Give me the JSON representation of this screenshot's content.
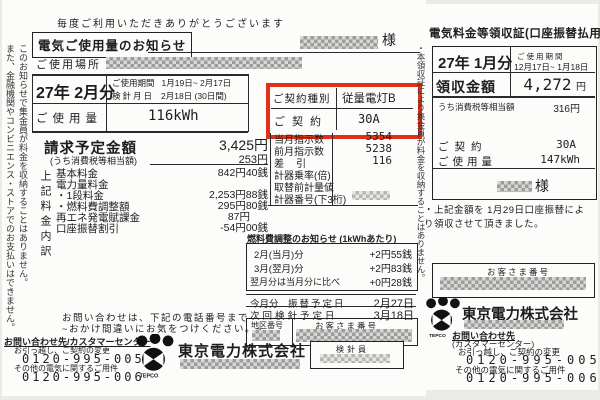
{
  "highlight_color": "#e23018",
  "company_logo_text": "TEPCO",
  "left_doc": {
    "side_note_1": "このお知らせで集金員が料金を収納することはありません。",
    "side_note_2": "また、金融機関やコンビニエンス・ストアでのお支払いはできません。",
    "thanks": "毎度ご利用いただきありがとうございます",
    "title": "電気ご使用量のお知らせ",
    "honorific": "様",
    "place_label": "ご使用場所",
    "billing_month": "27年 2月分",
    "period_label": "ご使用期間",
    "period_value": "1月19日~ 2月17日",
    "reading_label": "検針月日",
    "reading_value": "2月18日 (30日間)",
    "usage_label": "ご使用量",
    "usage_value": "116kWh",
    "contract_type_label": "ご契約種別",
    "contract_type_value": "従量電灯B",
    "contract_label": "ご契約",
    "contract_value": "30A",
    "billing_amount_label": "請求予定金額",
    "billing_amount_value": "3,425円",
    "tax_label": "(うち消費税等相当額)",
    "tax_value": "253円",
    "breakdown_side_label": "上記料金内訳",
    "breakdown": [
      {
        "label": "基本料金",
        "value": "842円40銭"
      },
      {
        "label": "電力量料金",
        "value": ""
      },
      {
        "label": "・1段料金",
        "value": "2,253円88銭"
      },
      {
        "label": "・燃料費調整額",
        "value": "295円80銭"
      },
      {
        "label": "再エネ発電賦課金",
        "value": "87円"
      },
      {
        "label": "口座振替割引",
        "value": "-54円00銭"
      }
    ],
    "meter": [
      {
        "label": "当月指示数",
        "value": "5354"
      },
      {
        "label": "前月指示数",
        "value": "5238"
      },
      {
        "label": "差引",
        "value": "116"
      },
      {
        "label": "計器乗率(倍)",
        "value": ""
      },
      {
        "label": "取替前計量値",
        "value": ""
      },
      {
        "label": "計器番号(下3桁)",
        "value": ""
      }
    ],
    "fuel_title": "燃料費調整のお知らせ (1kWhあたり)",
    "fuel_rows": [
      {
        "label": "2月(当月)分",
        "value": "+2円55銭"
      },
      {
        "label": "3月(翌月)分",
        "value": "+2円83銭"
      },
      {
        "label": "翌月分は当月分に比べ",
        "value": "+0円28銭"
      }
    ],
    "transfer_label_1": "今月分",
    "transfer_label_2": "振替予定日",
    "transfer_value": "2月27日",
    "next_reading_label": "次回検針予定日",
    "next_reading_value": "3月18日",
    "district_label": "地区番号",
    "customer_no_label": "お客さま番号",
    "meter_reader_label": "検針員",
    "contact_line1": "お問い合わせは、下記の電話番号まで",
    "contact_line2": "~おかけ間違いにお気をつけください。~",
    "contact_heading": "お問い合わせ先/カスタマーセンター",
    "phone1_label": "お引っ越し、ご契約の変更",
    "phone1": "0120-995-005",
    "phone2_label": "その他の電気に関するご用件",
    "phone2": "0120-995-006",
    "company": "東京電力株式会社"
  },
  "right_doc": {
    "title": "電気料金等領収証(口座振替払用)",
    "side_note": "・本領収証により集金員が料金を収納することはありません。",
    "billing_month": "27年 1月分",
    "period_label": "ご使用期間",
    "period_value": "12月17日~ 1月18日",
    "amount_label": "領収金額",
    "amount_value": "4,272",
    "amount_unit": "円",
    "tax_label": "うち消費税等相当額",
    "tax_value": "316円",
    "contract_label": "ご契約",
    "contract_value": "30A",
    "usage_label": "ご使用量",
    "usage_value": "147kWh",
    "honorific": "様",
    "receipt_note": "・上記金額を 1月29日口座振替により領収させて頂きました。",
    "customer_no_label": "お客さま番号",
    "company": "東京電力株式会社",
    "contact_heading": "お問い合わせ先",
    "contact_sub": "(カスタマーセンター)",
    "phone1_label": "お引っ越し、ご契約の変更",
    "phone1": "0120-995-005",
    "phone2_label": "その他の電気に関するご用件",
    "phone2": "0120-995-006"
  }
}
